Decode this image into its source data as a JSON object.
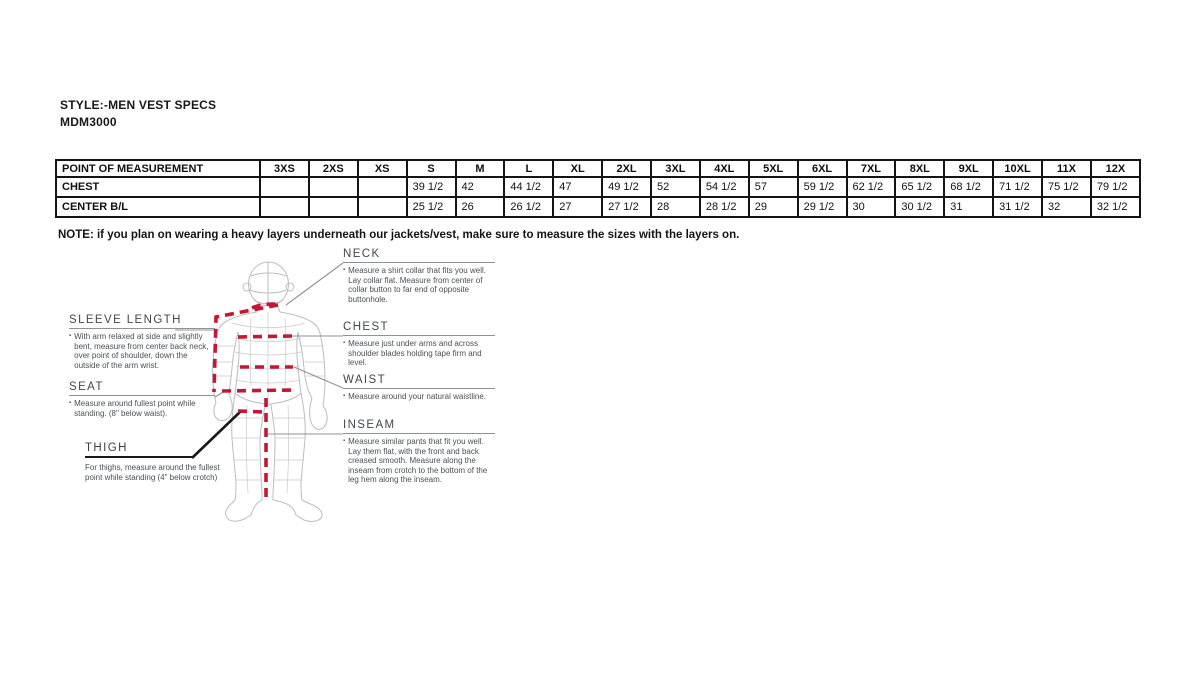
{
  "page": {
    "title_line1": "STYLE:-MEN VEST SPECS",
    "title_line2": "MDM3000",
    "note": "NOTE: if you plan on wearing a heavy layers underneath our jackets/vest, make sure to measure the sizes with the layers on."
  },
  "size_table": {
    "columns": [
      "POINT OF MEASUREMENT",
      "3XS",
      "2XS",
      "XS",
      "S",
      "M",
      "L",
      "XL",
      "2XL",
      "3XL",
      "4XL",
      "5XL",
      "6XL",
      "7XL",
      "8XL",
      "9XL",
      "10XL",
      "11X",
      "12X"
    ],
    "rows": [
      {
        "label": "CHEST",
        "values": [
          "",
          "",
          "",
          "39 1/2",
          "42",
          "44 1/2",
          "47",
          "49 1/2",
          "52",
          "54 1/2",
          "57",
          "59 1/2",
          "62 1/2",
          "65 1/2",
          "68 1/2",
          "71 1/2",
          "75 1/2",
          "79 1/2"
        ]
      },
      {
        "label": "CENTER B/L",
        "values": [
          "",
          "",
          "",
          "25 1/2",
          "26",
          "26 1/2",
          "27",
          "27 1/2",
          "28",
          "28 1/2",
          "29",
          "29 1/2",
          "30",
          "30 1/2",
          "31",
          "31 1/2",
          "32",
          "32 1/2"
        ]
      }
    ]
  },
  "diagram": {
    "bullet": "▪",
    "labels": {
      "sleeve_length": {
        "title": "SLEEVE LENGTH",
        "desc": "With arm relaxed at side and slightly bent, measure from center back neck, over point of shoulder, down the outside of the arm wrist."
      },
      "seat": {
        "title": "SEAT",
        "desc": "Measure around fullest point while standing. (8\" below waist)."
      },
      "thigh": {
        "title": "THIGH",
        "desc": "For thighs, measure around the fullest point while standing (4\" below crotch)"
      },
      "neck": {
        "title": "NECK",
        "desc": "Measure a shirt collar that fits you well. Lay collar flat. Measure from center of collar button to far end of opposite buttonhole."
      },
      "chest": {
        "title": "CHEST",
        "desc": "Measure just under arms and across shoulder blades holding tape firm and level."
      },
      "waist": {
        "title": "WAIST",
        "desc": "Measure around your natural waistline."
      },
      "inseam": {
        "title": "INSEAM",
        "desc": "Measure similar pants that fit you well. Lay them flat, with the front and back creased smooth. Measure along the inseam from crotch to the bottom of the leg hem along the inseam."
      }
    },
    "colors": {
      "measure_line": "#c41734",
      "figure_line": "#babdbf",
      "connector": "#8f9396"
    }
  }
}
